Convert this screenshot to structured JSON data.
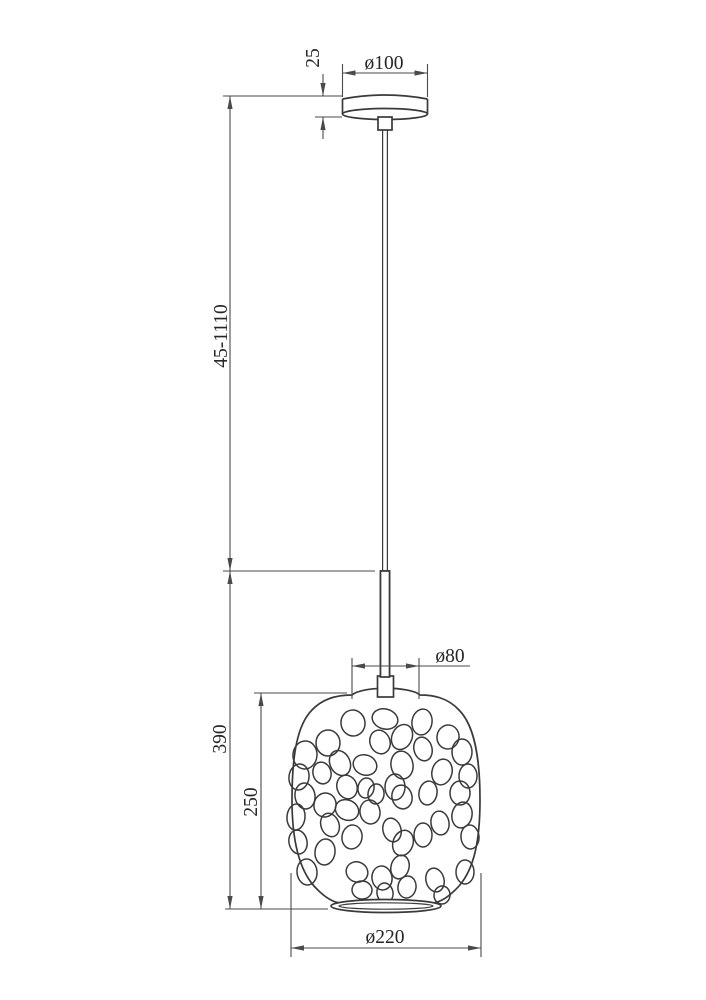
{
  "drawing": {
    "labels": {
      "canopy_diameter": "ø100",
      "canopy_height": "25",
      "suspension_height_range": "45-1110",
      "body_height": "390",
      "shade_height": "250",
      "shade_top_diameter": "ø80",
      "shade_diameter": "ø220"
    },
    "colors": {
      "line": "#3a3a3a",
      "dimension": "#4a4a4a",
      "text": "#262626",
      "background": "#ffffff"
    }
  }
}
